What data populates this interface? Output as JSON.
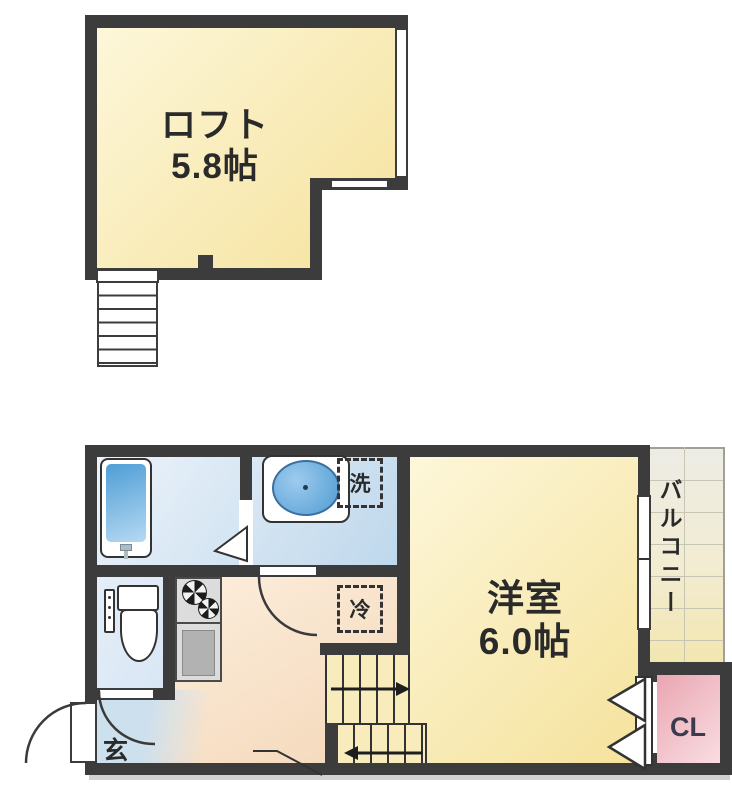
{
  "rooms": {
    "loft": {
      "label": "ロフト",
      "size": "5.8帖"
    },
    "western_room": {
      "label": "洋室",
      "size": "6.0帖"
    },
    "balcony": {
      "label": "バルコニー"
    },
    "closet": {
      "label": "CL"
    },
    "entrance": {
      "label": "玄"
    }
  },
  "fixtures": {
    "washing_machine": {
      "label": "洗"
    },
    "refrigerator": {
      "label": "冷"
    }
  },
  "colors": {
    "wall": "#3c3c3c",
    "line": "#333333",
    "text": "#2a2a2a",
    "cream1": "#fdf7da",
    "cream2": "#f5e29c",
    "blue1": "#ecf3fa",
    "blue2": "#bfd8ec",
    "toiletblue": "#d9e6f4",
    "peach1": "#fdf1e1",
    "peach2": "#f4d7b8",
    "genkan": "#cde0ee",
    "pink1": "#eaa6b2",
    "pink2": "#f9dde2",
    "balc1": "#edece5",
    "balc2": "#f2e6b0",
    "balcline": "#c9c5b3",
    "counter": "#dcdcdc",
    "sinkgrey": "#b2b2b2",
    "tub1": "#4e9ed6",
    "tub2": "#b6d9f2",
    "cltext": "#3b3b50",
    "shadow": "#c2c2c2"
  }
}
